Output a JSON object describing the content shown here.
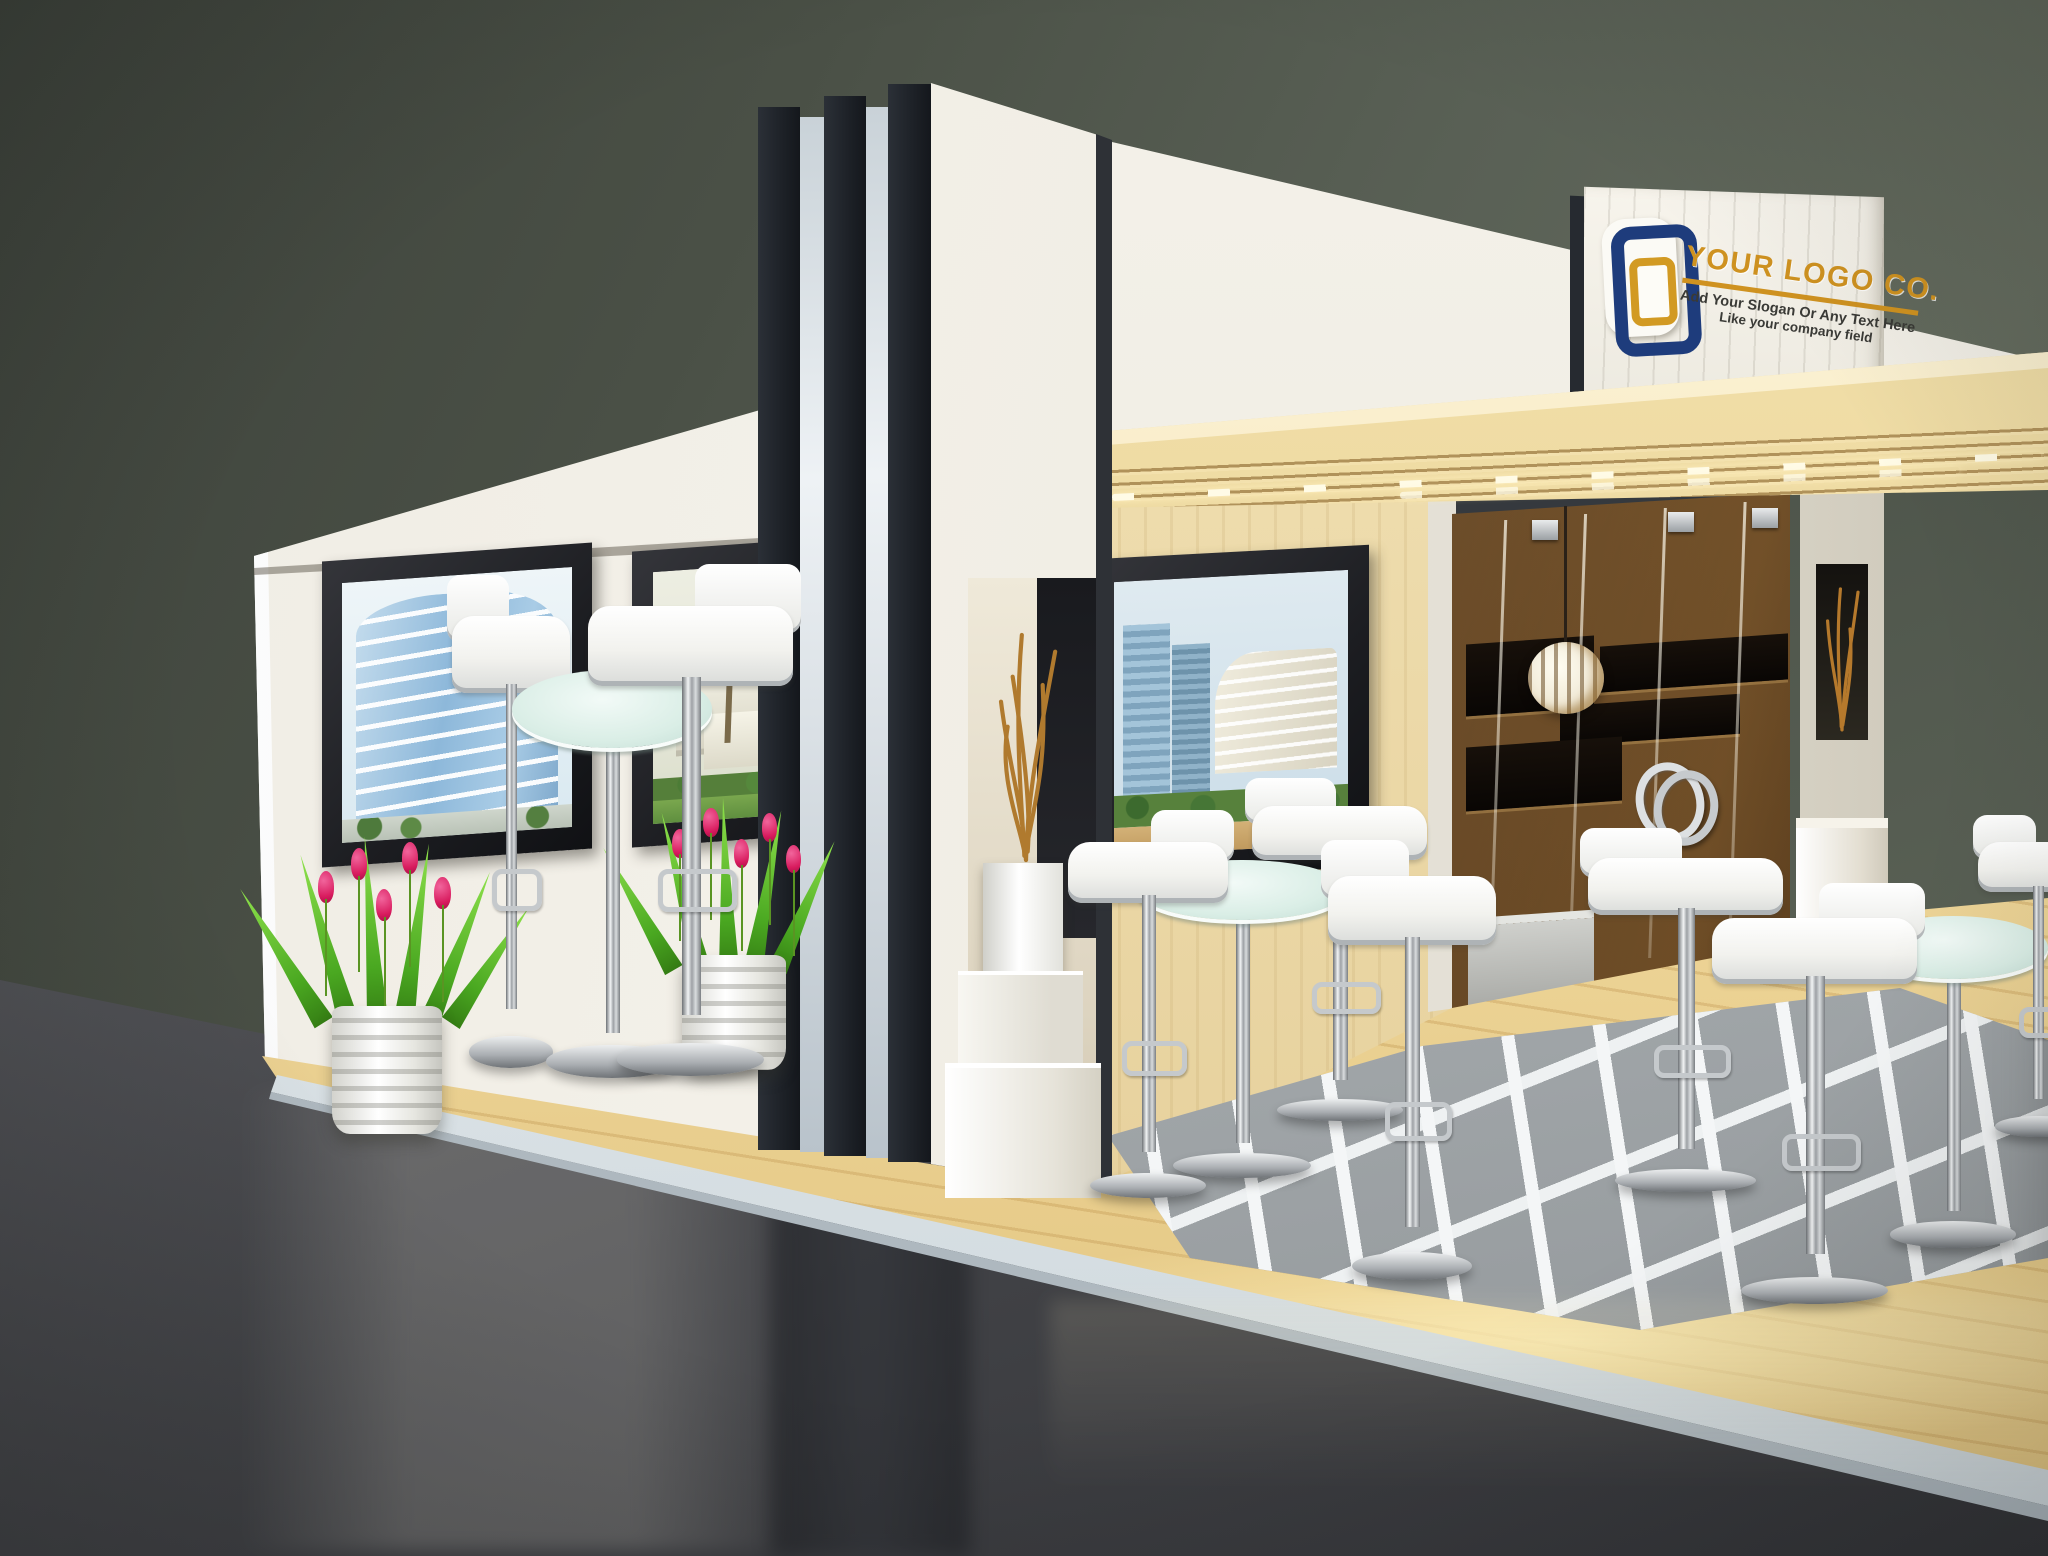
{
  "scene": {
    "description": "3D render of a modern trade-show exhibition booth with white walls, a black-striped tower, wooden canopy, glass-tile floor, white bar stools and round glass tables",
    "environment": {
      "backdrop": "dark olive-gray hall wall",
      "hall_floor": "glossy dark gray with reflections"
    }
  },
  "signage": {
    "logo_icon": "nested rounded squares (white plate, navy ring, gold ring)",
    "company_name": "YOUR LOGO CO.",
    "slogan_line1": "Add Your Slogan Or Any Text Here",
    "slogan_line2": "Like your company field"
  },
  "colors": {
    "logo_navy": "#1e3c7c",
    "logo_gold": "#cf9220",
    "canopy_wood": "#ecd69c",
    "booth_white": "#f1eee6",
    "stripe_dark": "#1e2228",
    "cabinet_brown": "#5e3f20",
    "background_wall": "#596055",
    "hall_floor": "#47484c",
    "tulip_pink": "#d81b5e",
    "leaf_green": "#4aa821",
    "glass_table": "#daeee6"
  },
  "artworks": {
    "left_wall": [
      "blue wavy high-rise building photo",
      "white villa with dome and palm tree photo"
    ],
    "interior_wall": [
      "modern city towers with palms photo"
    ]
  },
  "furniture": {
    "stools": "white low-back bar stools with chrome pedestals",
    "tables": "round frosted-glass bistro tables with chrome pedestals",
    "stool_count": 8,
    "table_count": 4
  },
  "decor": [
    "white ribbed pots with pink tulips",
    "golden twig arrangements in white cube vases",
    "white slatted pendant lamp",
    "chrome double-ring door handle"
  ]
}
